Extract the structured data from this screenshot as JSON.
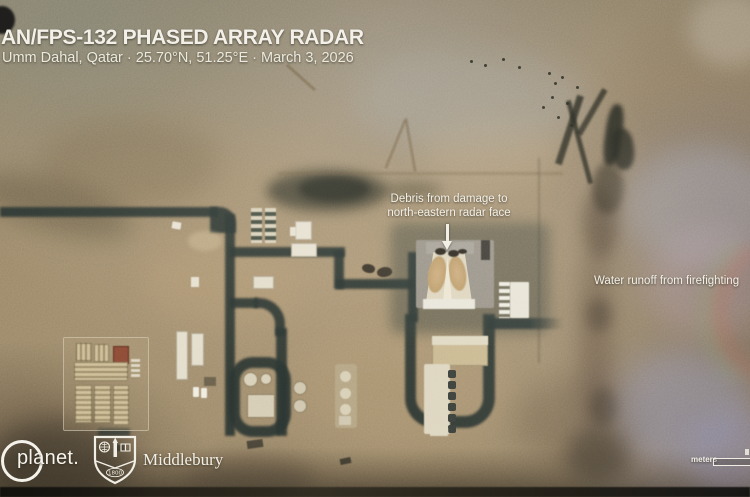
{
  "header": {
    "title": "AN/FPS-132 PHASED ARRAY RADAR",
    "subtitle": "Umm Dahal, Qatar · 25.70°N, 51.25°E · March 3, 2026"
  },
  "annotations": {
    "debris": {
      "line1": "Debris from damage to",
      "line2": "north-eastern radar face"
    },
    "runoff": {
      "text": "Water runoff from firefighting"
    }
  },
  "credits": {
    "planet": "planet.",
    "middlebury": "Middlebury",
    "shield_year": "1800"
  },
  "scalebar": {
    "label": "meters"
  },
  "icons": {
    "planet_ring": "circle-outline",
    "middlebury_shield": "shield-crest"
  },
  "colors": {
    "desert_tan": "#9a876a",
    "road_dark": "#2a3431",
    "annotation_text": "#f2f0e8",
    "radar_face_tan": "#c2a376",
    "building_white": "#e4ddc9",
    "soot_dark": "#23251c"
  }
}
